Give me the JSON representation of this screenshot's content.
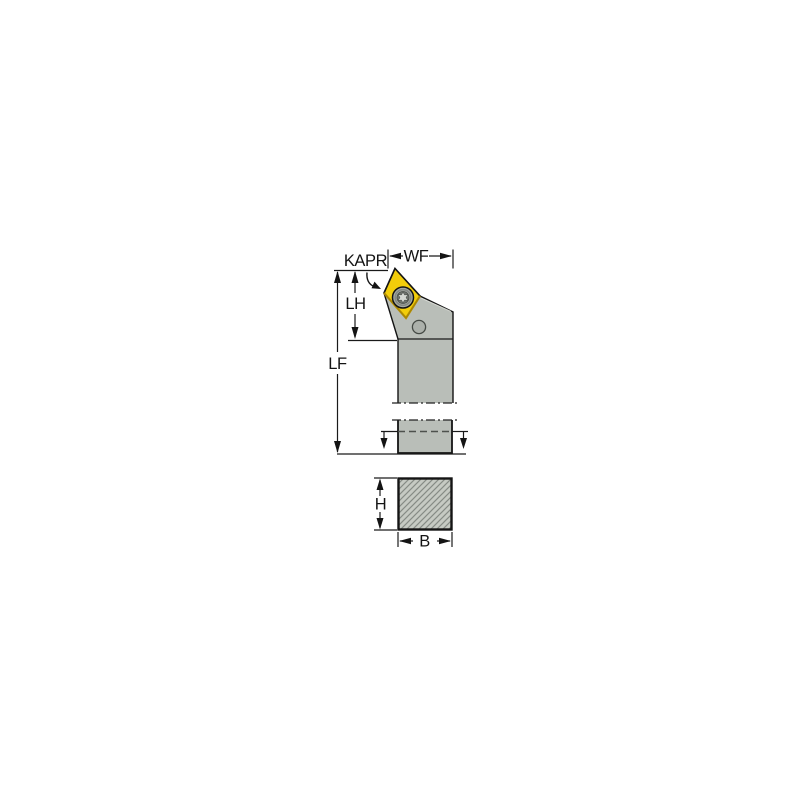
{
  "figure": {
    "type": "technical-diagram",
    "subject": "Turning tool holder with rhombic indexable insert: side view, shank section break, and square cross-section view"
  },
  "labels": {
    "kapr": "KAPR",
    "wf": "WF",
    "lh": "LH",
    "lf": "LF",
    "h": "H",
    "b": "B"
  },
  "colors": {
    "background": "#ffffff",
    "outline": "#1a1a1a",
    "body_gray": "#b9beb8",
    "section_fill": "#c6cac3",
    "hatch": "#868b85",
    "insert_yellow": "#f2cd0a",
    "insert_shadow": "#c39a00",
    "screw_ring": "#a7aca6",
    "screw_core": "#6f746e",
    "screw_star": "#d4d8d2",
    "hole_gray": "#acb1ab",
    "edge_highlight": "#daddd6"
  }
}
